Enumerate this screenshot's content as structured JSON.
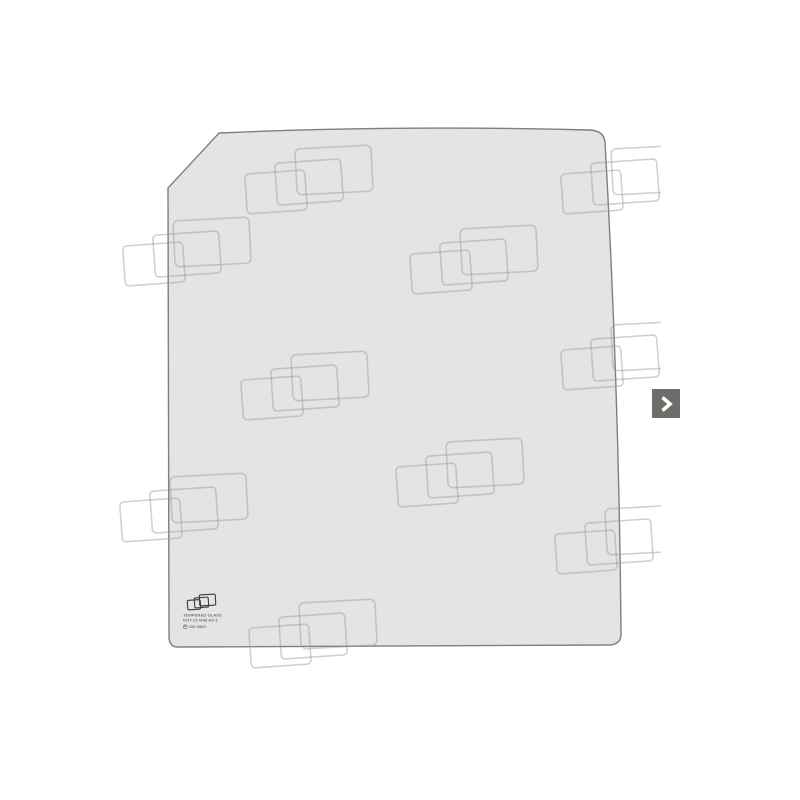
{
  "page": {
    "background": "#ffffff"
  },
  "product_photo": {
    "description_icon": "glass-panel-photo",
    "glass": {
      "fill": "#e4e4e4",
      "stroke": "#7f7f7f"
    },
    "watermark": {
      "color": "#999999",
      "opacity": 0.45,
      "clip_width": 661,
      "positions": [
        [
          240,
          142
        ],
        [
          556,
          142
        ],
        [
          118,
          214
        ],
        [
          405,
          222
        ],
        [
          236,
          348
        ],
        [
          556,
          318
        ],
        [
          391,
          435
        ],
        [
          115,
          470
        ],
        [
          550,
          502
        ],
        [
          244,
          596
        ]
      ]
    },
    "etching": {
      "line1": "TEMPERED GLASS",
      "line2": "DOT-29 M98 AS-1",
      "mark": "E",
      "line3": "GB 9963"
    }
  },
  "carousel": {
    "next_button": {
      "icon": "chevron-right-icon",
      "background": "#6f6d6a",
      "arrow_color": "#ffffff"
    }
  }
}
